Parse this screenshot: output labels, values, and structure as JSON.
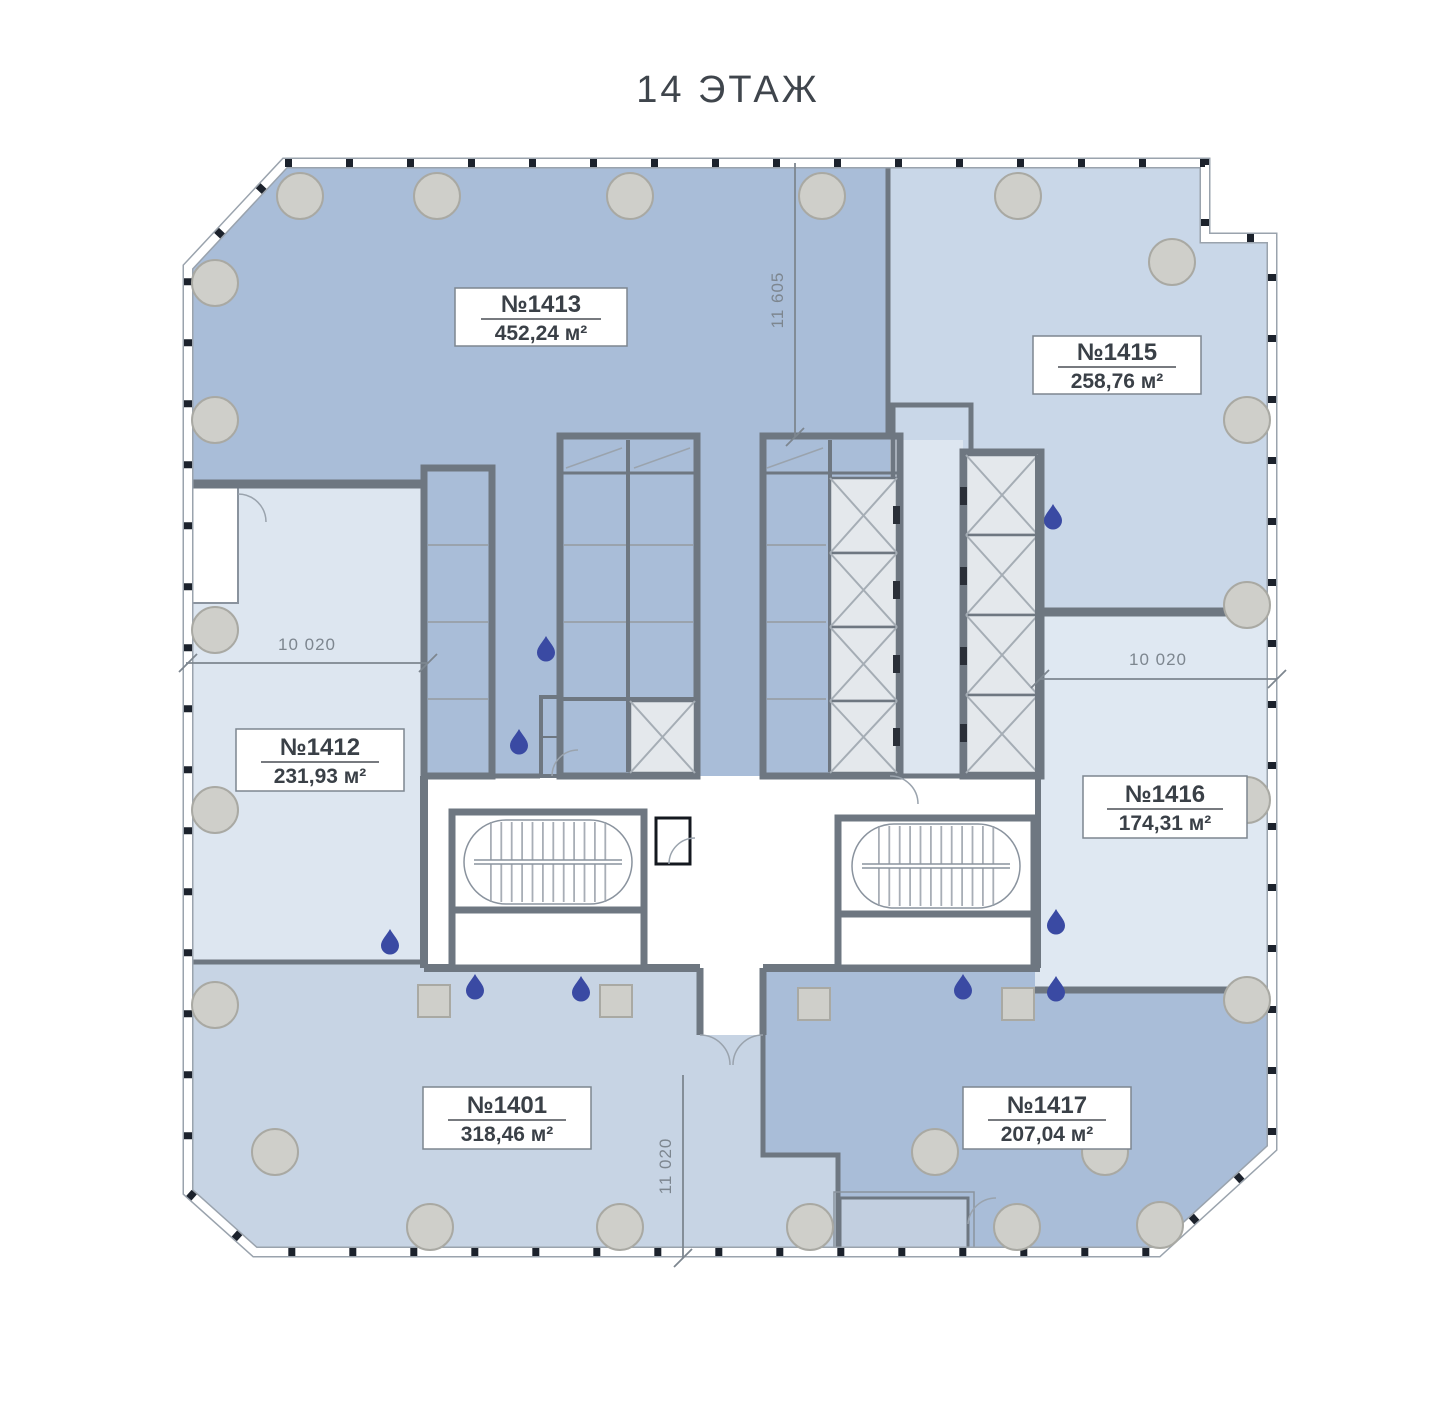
{
  "title": "14 ЭТАЖ",
  "units": [
    {
      "id": "1413",
      "number": "№1413",
      "area": "452,24 м²",
      "fill": "#a9bdd8"
    },
    {
      "id": "1415",
      "number": "№1415",
      "area": "258,76 м²",
      "fill": "#c9d7e8"
    },
    {
      "id": "1412",
      "number": "№1412",
      "area": "231,93 м²",
      "fill": "#dde6f0"
    },
    {
      "id": "1416",
      "number": "№1416",
      "area": "174,31 м²",
      "fill": "#dfe8f2"
    },
    {
      "id": "1401",
      "number": "№1401",
      "area": "318,46 м²",
      "fill": "#c7d4e4"
    },
    {
      "id": "1417",
      "number": "№1417",
      "area": "207,04 м²",
      "fill": "#a9bdd8"
    }
  ],
  "dimensions": [
    {
      "id": "top-vertical",
      "value": "11 605",
      "orientation": "vertical"
    },
    {
      "id": "left-horizontal",
      "value": "10 020",
      "orientation": "horizontal"
    },
    {
      "id": "right-horizontal",
      "value": "10 020",
      "orientation": "horizontal"
    },
    {
      "id": "bottom-vertical",
      "value": "11 020",
      "orientation": "vertical"
    }
  ],
  "colors": {
    "wall": "#6e7781",
    "curtain_edge": "#9aa3ad",
    "mullion": "#1c222c",
    "column_fill": "#cfcfca",
    "column_stroke": "#a9a9a3",
    "shaft_fill": "#e4e8ec",
    "drop": "#3a4aa3",
    "dim": "#7d868f",
    "label_border": "#7d868f"
  }
}
